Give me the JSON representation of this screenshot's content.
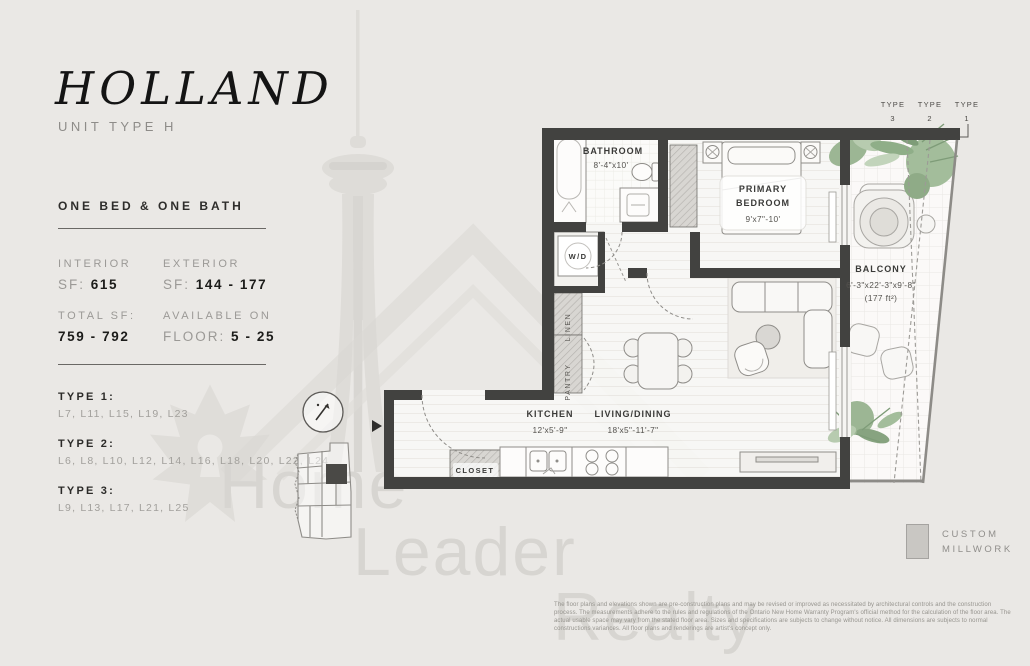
{
  "header": {
    "title": "HOLLAND",
    "subtitle": "UNIT TYPE H",
    "config": "ONE BED & ONE BATH"
  },
  "stats": {
    "interior_label": "INTERIOR",
    "interior_prefix": "SF:",
    "interior_value": "615",
    "exterior_label": "EXTERIOR",
    "exterior_prefix": "SF:",
    "exterior_value": "144 - 177",
    "total_label": "TOTAL SF:",
    "total_value": "759 - 792",
    "available_label": "AVAILABLE ON",
    "available_prefix": "FLOOR:",
    "available_value": "5 - 25"
  },
  "types": [
    {
      "label": "TYPE 1:",
      "levels": "L7, L11, L15, L19, L23"
    },
    {
      "label": "TYPE 2:",
      "levels": "L6, L8, L10, L12, L14, L16, L18, L20, L22, L24"
    },
    {
      "label": "TYPE 3:",
      "levels": "L9, L13, L17, L21, L25"
    }
  ],
  "plan": {
    "bathroom_name": "BATHROOM",
    "bathroom_dims": "8'-4\"x10'",
    "bedroom_name1": "PRIMARY",
    "bedroom_name2": "BEDROOM",
    "bedroom_dims": "9'x7\"-10'",
    "balcony_name": "BALCONY",
    "balcony_dims": "6'-3\"x22'-3\"x9'-8\"",
    "balcony_area": "(177 ft²)",
    "kitchen_name": "KITCHEN",
    "kitchen_dims": "12'x5'-9\"",
    "living_name": "LIVING/DINING",
    "living_dims": "18'x5\"-11'-7\"",
    "closet": "CLOSET",
    "wd": "W/D",
    "linen": "LINEN",
    "pantry": "PANTRY",
    "btype3_l1": "TYPE",
    "btype3_l2": "3",
    "btype2_l1": "TYPE",
    "btype2_l2": "2",
    "btype1_l1": "TYPE",
    "btype1_l2": "1"
  },
  "legend": {
    "line1": "CUSTOM",
    "line2": "MILLWORK"
  },
  "watermark": {
    "w1": "Home",
    "w2": "Leader",
    "w3": "Realty"
  },
  "disclaimer": "The floor plans and elevations shown are pre-construction plans and may be revised or improved as necessitated by architectural controls and the construction process. The measurements adhere to the rules and regulations of the Ontario New Home Warranty Program's official method for the calculation of the floor area.  The actual usable space may vary from the stated floor area. Sizes and specifications are subjects to change without notice. All dimensions are subjects to normal constructions variances. All floor plans and renderings are artist's concept only."
}
